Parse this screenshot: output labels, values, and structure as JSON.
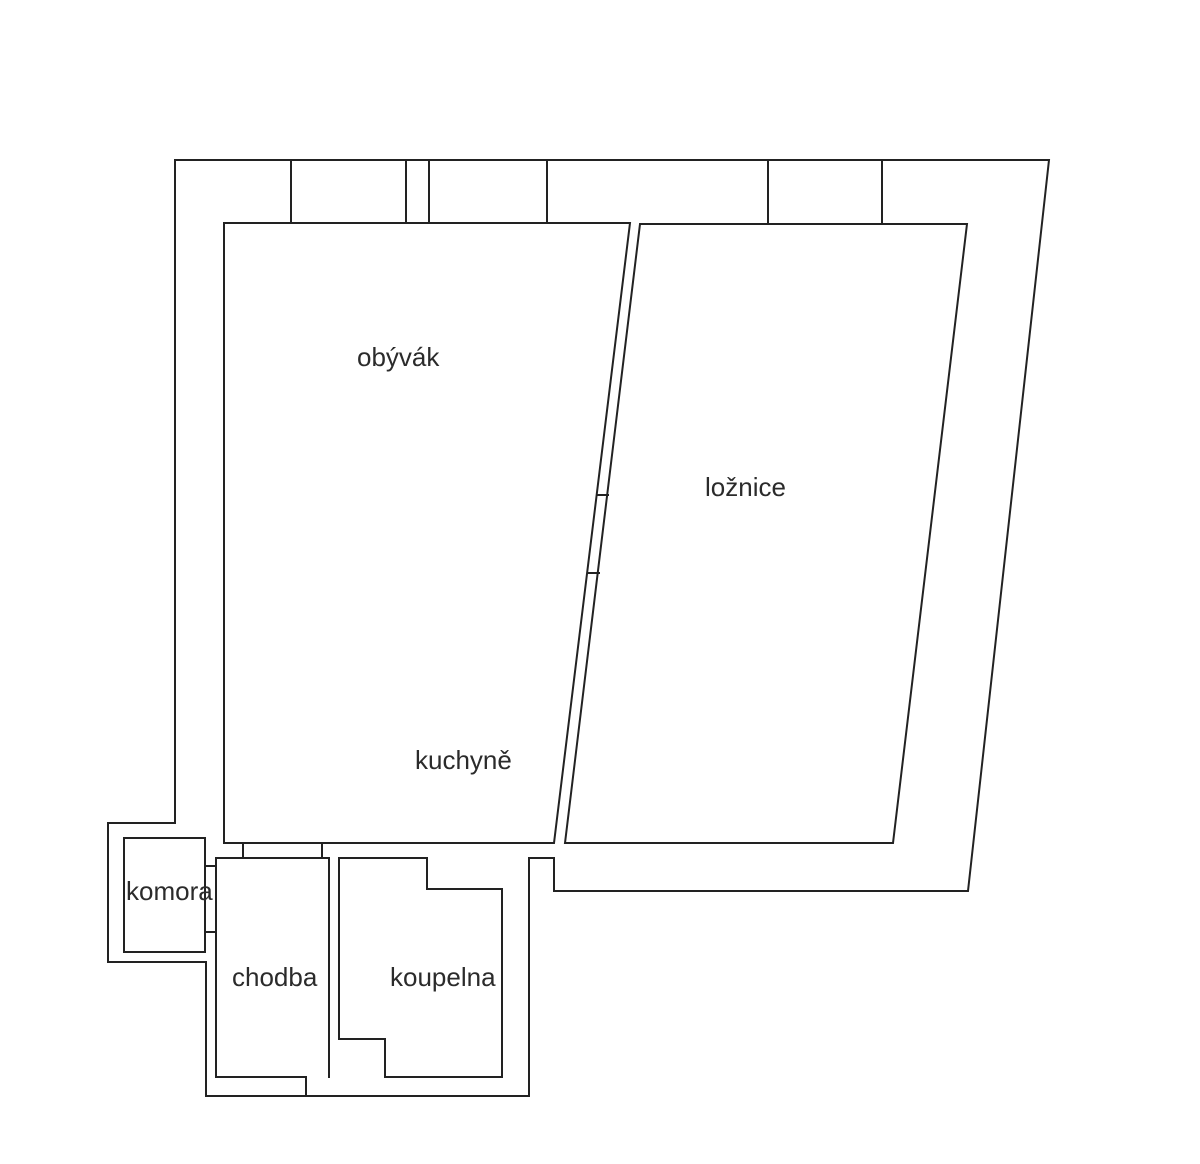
{
  "page": {
    "background": "#ffffff"
  },
  "floorplan": {
    "canvas": {
      "width": 1200,
      "height": 1164
    },
    "stroke_color": "#222222",
    "stroke_width": 2,
    "label_color": "#2b2b2b",
    "label_font_size": 26,
    "walls": [
      {
        "name": "outer-boundary",
        "closed": true,
        "points": [
          [
            175,
            160
          ],
          [
            1049,
            160
          ],
          [
            968,
            891
          ],
          [
            554,
            891
          ],
          [
            554,
            858
          ],
          [
            529,
            858
          ],
          [
            529,
            1096
          ],
          [
            206,
            1096
          ],
          [
            206,
            962
          ],
          [
            108,
            962
          ],
          [
            108,
            823
          ],
          [
            175,
            823
          ]
        ]
      },
      {
        "name": "living-kitchen-outline",
        "closed": true,
        "points": [
          [
            224,
            223
          ],
          [
            630,
            223
          ],
          [
            554,
            843
          ],
          [
            224,
            843
          ]
        ]
      },
      {
        "name": "bedroom-outline",
        "closed": true,
        "points": [
          [
            640,
            224
          ],
          [
            967,
            224
          ],
          [
            893,
            843
          ],
          [
            565,
            843
          ]
        ]
      },
      {
        "name": "top-wall-divider-1",
        "closed": false,
        "points": [
          [
            291,
            160
          ],
          [
            291,
            223
          ]
        ]
      },
      {
        "name": "top-wall-divider-2",
        "closed": false,
        "points": [
          [
            406,
            160
          ],
          [
            406,
            223
          ]
        ]
      },
      {
        "name": "top-wall-divider-3",
        "closed": false,
        "points": [
          [
            429,
            160
          ],
          [
            429,
            223
          ]
        ]
      },
      {
        "name": "top-wall-divider-4",
        "closed": false,
        "points": [
          [
            547,
            160
          ],
          [
            547,
            223
          ]
        ]
      },
      {
        "name": "top-wall-divider-5",
        "closed": false,
        "points": [
          [
            768,
            160
          ],
          [
            768,
            224
          ]
        ]
      },
      {
        "name": "top-wall-divider-6",
        "closed": false,
        "points": [
          [
            882,
            160
          ],
          [
            882,
            224
          ]
        ]
      },
      {
        "name": "bedroom-door-jamb-upper",
        "closed": false,
        "points": [
          [
            598,
            495
          ],
          [
            608,
            495
          ]
        ]
      },
      {
        "name": "bedroom-door-jamb-lower",
        "closed": false,
        "points": [
          [
            588,
            573
          ],
          [
            599,
            573
          ]
        ]
      },
      {
        "name": "pantry-outline",
        "closed": true,
        "points": [
          [
            124,
            838
          ],
          [
            205,
            838
          ],
          [
            205,
            952
          ],
          [
            124,
            952
          ]
        ]
      },
      {
        "name": "pantry-door-jamb-upper",
        "closed": false,
        "points": [
          [
            205,
            866
          ],
          [
            216,
            866
          ]
        ]
      },
      {
        "name": "pantry-door-jamb-lower",
        "closed": false,
        "points": [
          [
            205,
            932
          ],
          [
            216,
            932
          ]
        ]
      },
      {
        "name": "hallway-outline",
        "closed": false,
        "points": [
          [
            306,
            1096
          ],
          [
            306,
            1077
          ],
          [
            216,
            1077
          ],
          [
            216,
            858
          ],
          [
            329,
            858
          ],
          [
            329,
            1077
          ]
        ]
      },
      {
        "name": "kitchen-hallway-door-jamb-left",
        "closed": false,
        "points": [
          [
            243,
            843
          ],
          [
            243,
            858
          ]
        ]
      },
      {
        "name": "kitchen-hallway-door-jamb-right",
        "closed": false,
        "points": [
          [
            322,
            843
          ],
          [
            322,
            858
          ]
        ]
      },
      {
        "name": "bathroom-outline",
        "closed": true,
        "points": [
          [
            339,
            858
          ],
          [
            427,
            858
          ],
          [
            427,
            889
          ],
          [
            502,
            889
          ],
          [
            502,
            1077
          ],
          [
            385,
            1077
          ],
          [
            385,
            1039
          ],
          [
            339,
            1039
          ]
        ]
      }
    ],
    "labels": [
      {
        "name": "room-label-obyvak",
        "text": "obývák",
        "x": 357,
        "y": 366
      },
      {
        "name": "room-label-loznice",
        "text": "ložnice",
        "x": 705,
        "y": 496
      },
      {
        "name": "room-label-kuchyne",
        "text": "kuchyně",
        "x": 415,
        "y": 769
      },
      {
        "name": "room-label-komora",
        "text": "komora",
        "x": 126,
        "y": 900
      },
      {
        "name": "room-label-chodba",
        "text": "chodba",
        "x": 232,
        "y": 986
      },
      {
        "name": "room-label-koupelna",
        "text": "koupelna",
        "x": 390,
        "y": 986
      }
    ]
  }
}
